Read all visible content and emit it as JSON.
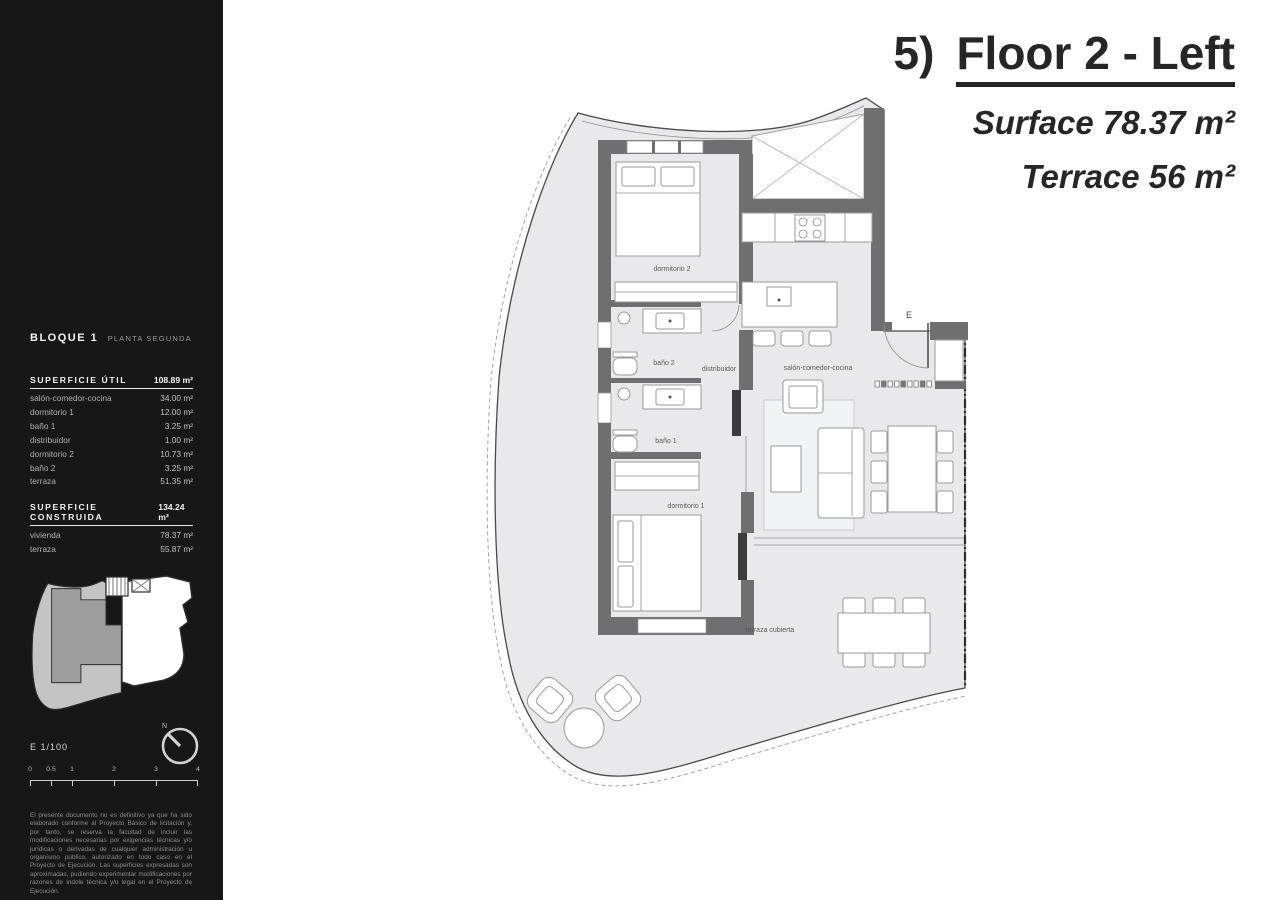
{
  "header": {
    "number": "5)",
    "title": "Floor 2 - Left",
    "surface": "Surface 78.37 m²",
    "terrace": "Terrace 56 m²"
  },
  "sidebar": {
    "block_title": "BLOQUE 1",
    "block_subtitle": "PLANTA SEGUNDA",
    "superficie_util": {
      "label": "SUPERFICIE ÚTIL",
      "total": "108.89 m²",
      "rows": [
        {
          "name": "salón-comedor-cocina",
          "value": "34.00 m²"
        },
        {
          "name": "dormitorio 1",
          "value": "12.00 m²"
        },
        {
          "name": "baño 1",
          "value": "3.25 m²"
        },
        {
          "name": "distribuidor",
          "value": "1.00 m²"
        },
        {
          "name": "dormitorio 2",
          "value": "10.73 m²"
        },
        {
          "name": "baño 2",
          "value": "3.25 m²"
        },
        {
          "name": "terraza",
          "value": "51.35 m²"
        }
      ]
    },
    "superficie_construida": {
      "label": "SUPERFICIE CONSTRUIDA",
      "total": "134.24 m²",
      "rows": [
        {
          "name": "vivienda",
          "value": "78.37 m²"
        },
        {
          "name": "terraza",
          "value": "55.87 m²"
        }
      ]
    },
    "scale": {
      "label": "E 1/100",
      "north_label": "N",
      "ticks": [
        "0",
        "0.5",
        "1",
        "2",
        "3",
        "4"
      ]
    },
    "disclaimer": "El presente documento no es definitivo ya que ha sido elaborado conforme al Proyecto Básico de licitación y, por tanto, se reserva la facultad de incluir las modificaciones necesarias por exigencias técnicas y/o jurídicas o derivadas de cualquier administración u organismo público, autorizado en todo caso en el Proyecto de Ejecución. Las superficies expresadas son aproximadas, pudiendo experimentar modificaciones por razones de índole técnica y/o legal en el Proyecto de Ejecución."
  },
  "plan": {
    "labels": {
      "dormitorio2": "dormitorio 2",
      "bano2": "baño 2",
      "distribuidor": "distribuidor",
      "bano1": "baño 1",
      "dormitorio1": "dormitorio 1",
      "salon": "salón-comedor-cocina",
      "terraza": "terraza cubierta",
      "entrance": "E"
    }
  },
  "colors": {
    "sidebar_bg": "#171717",
    "wall": "#6f6f6f",
    "floor": "#e9e9ec",
    "title_text": "#262626",
    "thumb_unit": "#9e9e9e",
    "thumb_terrace": "#c4c4c4"
  }
}
